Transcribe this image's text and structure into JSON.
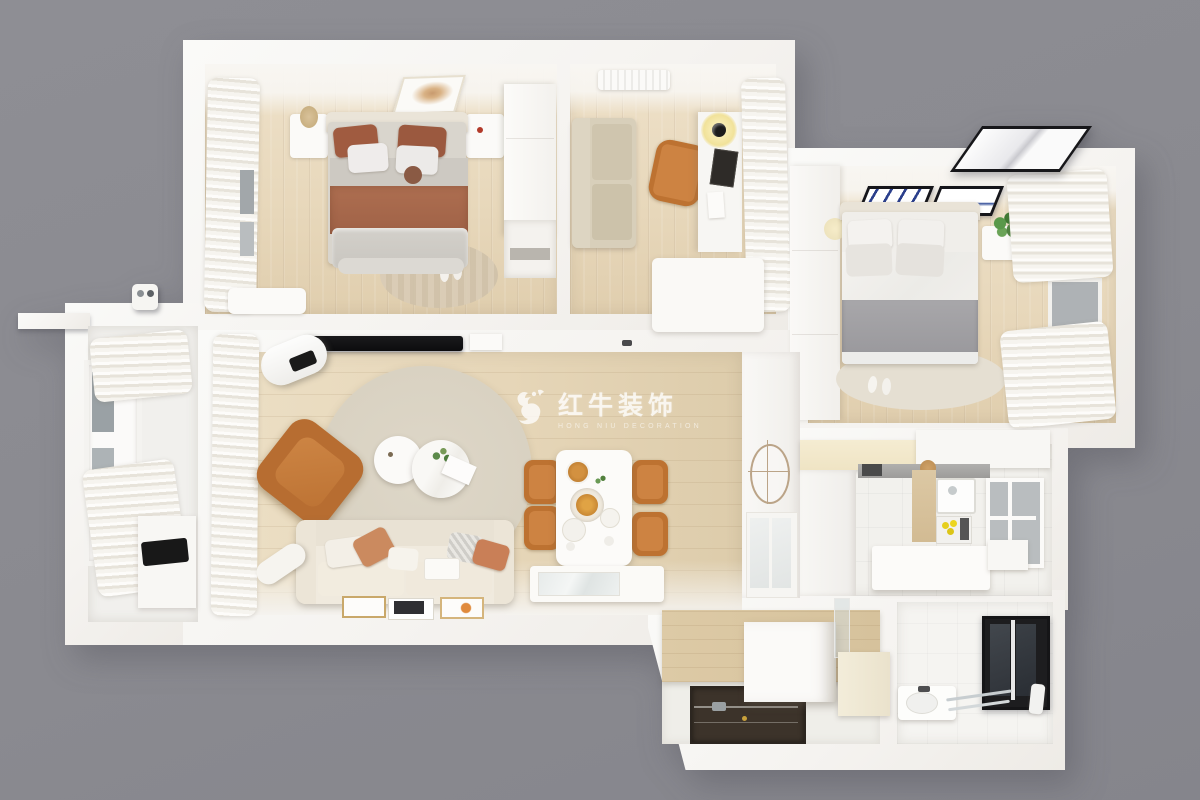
{
  "watermark": {
    "logo": "bull-icon",
    "brand_cn": "红牛装饰",
    "brand_en": "HONG NIU DECORATION"
  },
  "palette": {
    "background_gray": "#8a8a90",
    "wall_white": "#f6f4f1",
    "wood_floor": "#e7d7ba",
    "tile_floor": "#f2f1ed",
    "accent_orange": "#c47a36",
    "terracotta_textile": "#a25e42",
    "gray_blanket": "#a2a1a4",
    "beige_rug": "#ddd6c6",
    "dark_door_mat": "#3c332a",
    "tv_black": "#101010",
    "window_frame_black": "#1d1d1f",
    "plant_green": "#4e8340"
  },
  "scene": {
    "view": "top-down 3d apartment floor plan render",
    "rooms": [
      {
        "name": "bedroom-1",
        "furniture": [
          "double-bed",
          "terracotta-pillows",
          "nightstand-left",
          "nightstand-right",
          "wardrobe",
          "wall-art",
          "curtains",
          "half-round-rug",
          "slippers",
          "bench"
        ]
      },
      {
        "name": "study",
        "furniture": [
          "loveseat",
          "desk",
          "desk-chair",
          "desk-lamp",
          "air-conditioner",
          "curtains",
          "low-cabinet"
        ]
      },
      {
        "name": "bedroom-2",
        "furniture": [
          "double-bed",
          "gray-blanket",
          "nightstand",
          "potted-plant",
          "wardrobe",
          "wall-art-blue-1",
          "wall-art-blue-2",
          "curtains",
          "window",
          "oval-rug",
          "slippers",
          "exterior-skylight-panel"
        ]
      },
      {
        "name": "living-room",
        "furniture": [
          "tv",
          "media-shelf",
          "sofa",
          "throw-pillows",
          "bolster",
          "armchair-orange",
          "round-rug",
          "coffee-table-small",
          "coffee-table-large",
          "plant-sprig",
          "floor-picture-frames",
          "curtains",
          "air-purifier"
        ]
      },
      {
        "name": "dining-area",
        "furniture": [
          "dining-table",
          "dining-chairs-orange-x4",
          "plates-and-food",
          "sideboard",
          "partition-with-oval-mirror",
          "glass-display-cabinet"
        ]
      },
      {
        "name": "kitchen",
        "furniture": [
          "cream-upper-cabinets",
          "white-cabinets",
          "counter",
          "sink",
          "stove",
          "lemons",
          "window",
          "island-counter",
          "tall-cabinet"
        ]
      },
      {
        "name": "balcony",
        "furniture": [
          "curtain-top",
          "curtain-bottom",
          "window",
          "cabinet",
          "black-tray",
          "exterior-utility-box"
        ]
      },
      {
        "name": "entry-hall",
        "furniture": [
          "wood-paneling",
          "dark-door-mat",
          "shoe-cabinet",
          "bench",
          "frosted-glass-panel"
        ]
      },
      {
        "name": "bathroom",
        "furniture": [
          "black-frame-window",
          "vanity-sink",
          "faucet",
          "towel-rail"
        ]
      }
    ]
  }
}
